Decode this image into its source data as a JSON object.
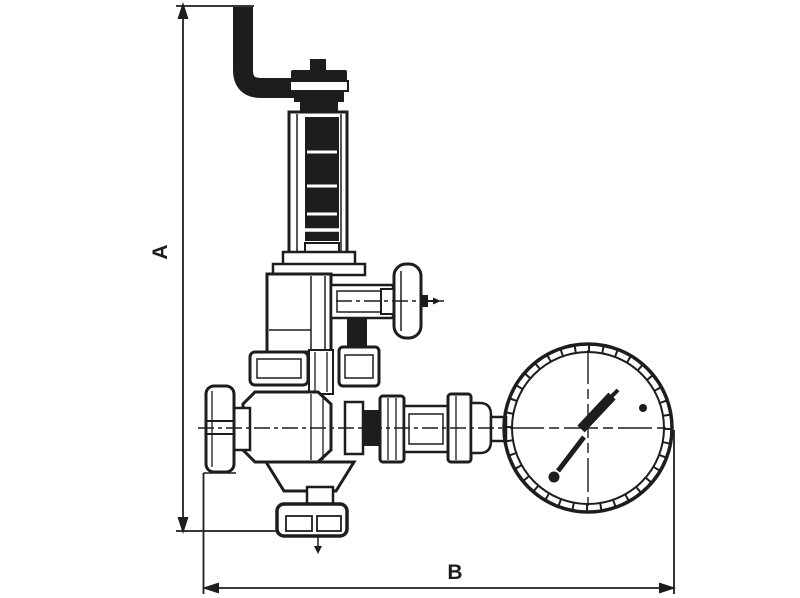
{
  "figure": {
    "type": "technical line drawing",
    "subject": "spring-loaded pressure reducing valve with shut-off handwheels, discharge pipe and pressure gauge",
    "style": "black outlines on white"
  },
  "colors": {
    "ink": "#1d1d1b",
    "paper": "#ffffff"
  },
  "dimensions": {
    "a": {
      "label": "A"
    },
    "b": {
      "label": "B"
    }
  }
}
